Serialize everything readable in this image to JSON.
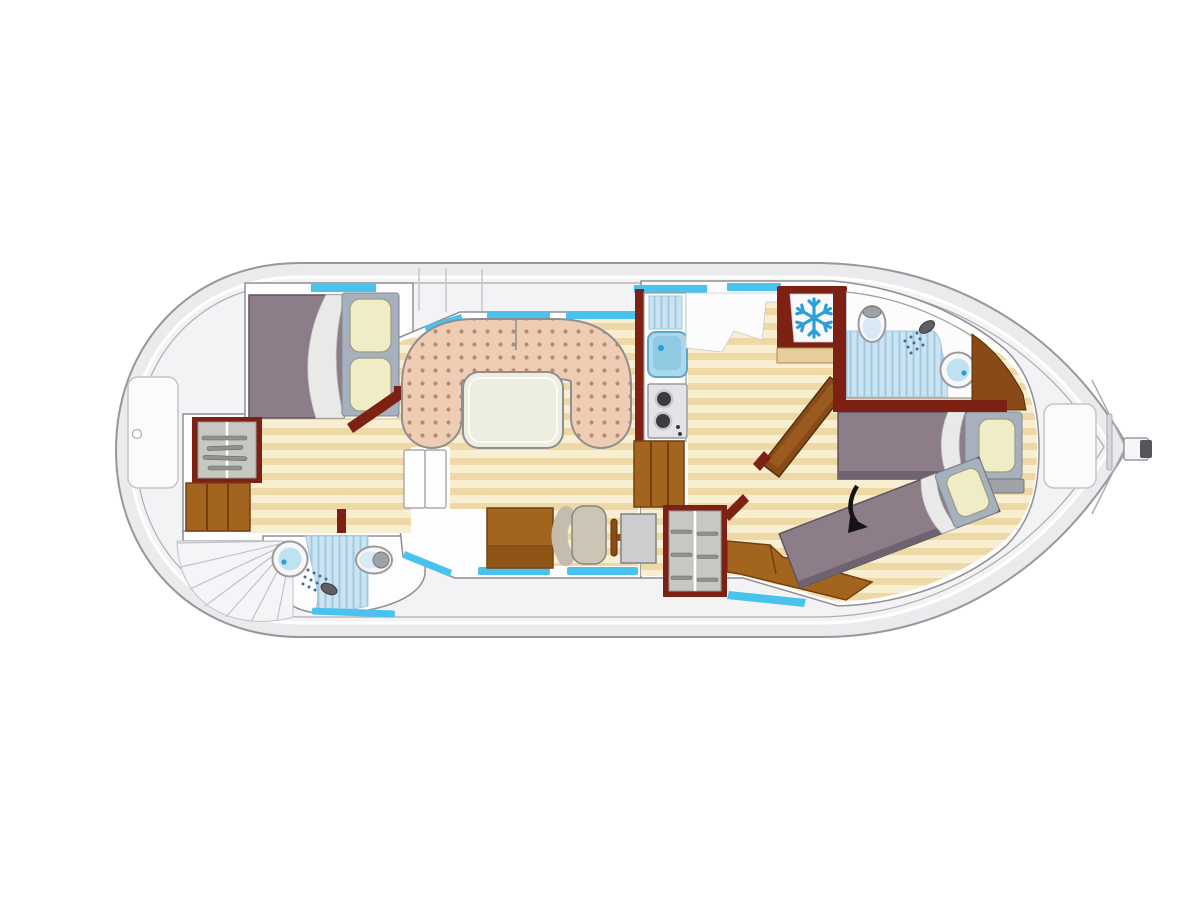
{
  "diagram": {
    "type": "boat-deck-floorplan",
    "orientation": "bow-right",
    "rooms": [
      {
        "name": "front-cabin",
        "furniture": [
          "double-bed",
          "pillows",
          "folded-sheet",
          "hanging-wardrobe",
          "cabinet",
          "open-door"
        ]
      },
      {
        "name": "front-bathroom",
        "furniture": [
          "washbasin",
          "shower",
          "toilet"
        ]
      },
      {
        "name": "companionway",
        "furniture": [
          "curved-stairs",
          "deck-steps"
        ]
      },
      {
        "name": "saloon",
        "furniture": [
          "u-shaped-sofa",
          "dinette-table",
          "storage-cupboard",
          "helm-bench",
          "helm-chair",
          "steering-wheel",
          "helm-console"
        ]
      },
      {
        "name": "galley",
        "furniture": [
          "drainer",
          "sink",
          "two-burner-stove",
          "cabinet",
          "refrigerator",
          "worktop"
        ]
      },
      {
        "name": "aft-cabin",
        "furniture": [
          "single-bed",
          "angled-single-bed",
          "corner-bench",
          "hanging-wardrobe",
          "open-door",
          "shelf"
        ]
      },
      {
        "name": "aft-bathroom",
        "furniture": [
          "toilet",
          "shower",
          "washbasin",
          "wood-partition"
        ]
      }
    ],
    "deck_items": [
      "bow-hatch",
      "stern-hatch",
      "rudder",
      "deck-lines"
    ],
    "icons": [
      "snowflake-icon",
      "shower-head-icon",
      "shower-spray-icon",
      "conversion-arrow-icon",
      "clothes-hanger-icon"
    ],
    "window_color_note": "cyan strips along hull walls are windows",
    "colors": {
      "hull_fill": "#EBEBED",
      "hull_line": "#97979D",
      "deck_fill": "#F3F3F5",
      "deck_line": "#ACACB2",
      "room_fill": "#FDFDFE",
      "wall_line": "#8F8F95",
      "floor_light": "#F8EFD2",
      "floor_dark": "#EED8A6",
      "maroon": "#7E2115",
      "brown": "#A2641F",
      "brown_dark": "#73400E",
      "brown_mid": "#8A4A17",
      "purple": "#8C7D88",
      "purple_dark": "#6F6370",
      "pillow": "#F0ECC5",
      "panel_gray": "#A7B0BD",
      "sofa": "#EFCDB5",
      "sofa_dot": "#B78B6F",
      "sofa_line": "#8E8E93",
      "table": "#EDEDE1",
      "cyan": "#49C3EE",
      "water": "#CBE4F2",
      "water_stripe": "#A3C9E0",
      "fixture_blue": "#BFE2F2",
      "blue_dot": "#2D9FD8",
      "steel": "#E4E4E6",
      "burner": "#3A3A3F",
      "chair": "#CCC5B6",
      "console": "#CDCDCF",
      "stairs_line": "#C2C2C8",
      "arrow": "#141414",
      "counter_tan": "#E9CD9E",
      "sheet": "#E9E9E7",
      "hanger": "#92928D"
    }
  }
}
